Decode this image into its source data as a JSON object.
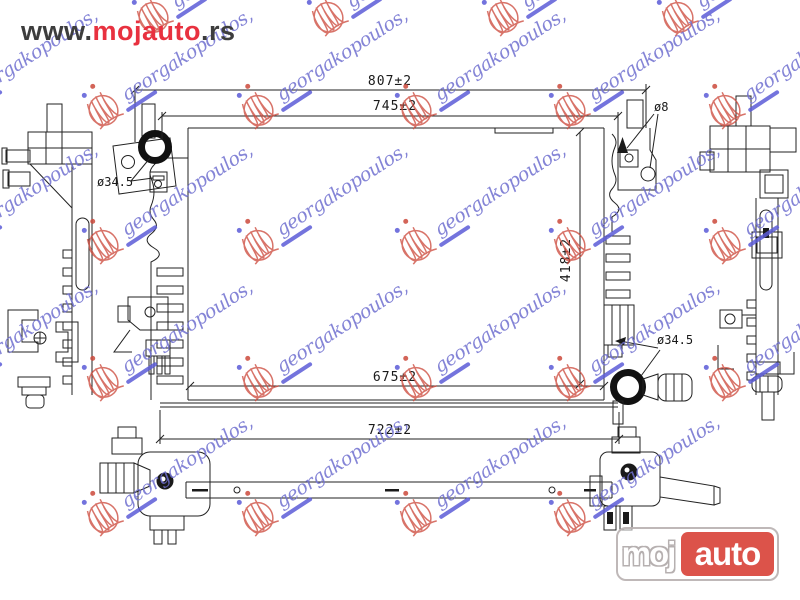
{
  "site_header": {
    "prefix": "www.",
    "brand": "mojauto",
    "suffix": ".rs"
  },
  "drawing": {
    "title": "radiator technical drawing",
    "dimensions": {
      "top_overall": "807±2",
      "top_inner": "745±2",
      "side_height": "418±2",
      "bottom_inner": "675±2",
      "bottom_overall": "722±2",
      "inlet_diameter": "ø34.5",
      "outlet_diameter": "ø34.5",
      "mount_hole_diameter": "ø8"
    }
  },
  "watermark": {
    "text": "georgakopoulos,",
    "positions": [
      {
        "x": 148,
        "y": 40
      },
      {
        "x": 323,
        "y": 40
      },
      {
        "x": 498,
        "y": 40
      },
      {
        "x": 673,
        "y": 40
      },
      {
        "x": -57,
        "y": 133
      },
      {
        "x": 98,
        "y": 133
      },
      {
        "x": 253,
        "y": 133
      },
      {
        "x": 411,
        "y": 133
      },
      {
        "x": 565,
        "y": 133
      },
      {
        "x": 720,
        "y": 133
      },
      {
        "x": -57,
        "y": 268
      },
      {
        "x": 98,
        "y": 268
      },
      {
        "x": 253,
        "y": 268
      },
      {
        "x": 411,
        "y": 268
      },
      {
        "x": 565,
        "y": 268
      },
      {
        "x": 720,
        "y": 268
      },
      {
        "x": -57,
        "y": 405
      },
      {
        "x": 98,
        "y": 405
      },
      {
        "x": 253,
        "y": 405
      },
      {
        "x": 411,
        "y": 405
      },
      {
        "x": 565,
        "y": 405
      },
      {
        "x": 720,
        "y": 405
      },
      {
        "x": 98,
        "y": 540
      },
      {
        "x": 253,
        "y": 540
      },
      {
        "x": 411,
        "y": 540
      },
      {
        "x": 565,
        "y": 540
      }
    ]
  },
  "logo": {
    "left": "moj",
    "right": "auto"
  },
  "colors": {
    "brand_red": "#e8313f",
    "logo_red": "#db4a41",
    "watermark_blue": "#6f6fd0",
    "watermark_red": "#cc4a3c",
    "line": "#222222"
  }
}
